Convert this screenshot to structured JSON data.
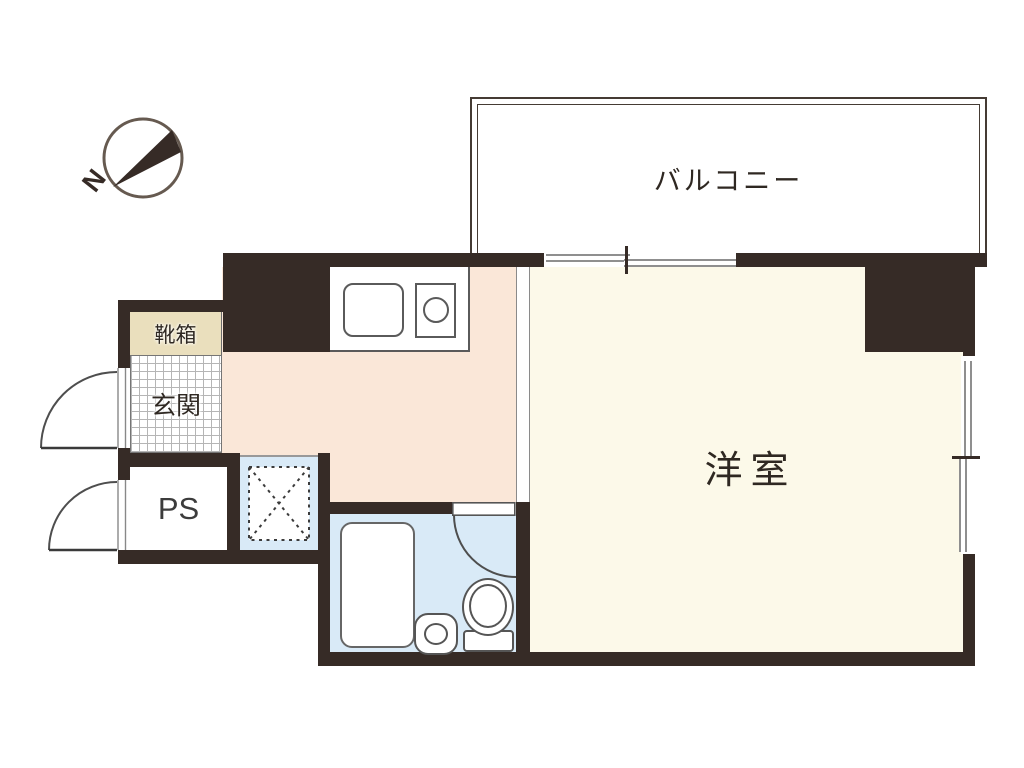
{
  "plan": {
    "compass": {
      "north_label": "N"
    },
    "rooms": {
      "balcony": {
        "label": "バルコニー"
      },
      "western_room": {
        "label": "洋室"
      },
      "entrance": {
        "label": "玄関"
      },
      "shoe_box": {
        "label": "靴箱"
      },
      "pipe_space": {
        "label": "PS"
      }
    },
    "colors": {
      "wall": "#362b26",
      "kitchen_hall_floor": "#fae7d8",
      "western_room_floor": "#fcf9e9",
      "bathroom_floor": "#d9eaf7",
      "shoe_box_fill": "#eadfbd",
      "entrance_grid": "#b5b5b5",
      "window_frame": "#8f8f8f"
    },
    "fixtures": {
      "kitchen_sink": "kitchen-sink",
      "stove": "single-burner-stove",
      "bathtub": "bathtub",
      "wash_basin": "wash-basin",
      "toilet": "toilet",
      "washer_space": "crossed-dashed-box",
      "entrance_door": "outward-swing-door",
      "pipe_space_door": "outward-swing-door",
      "bathroom_door": "inward-swing-door",
      "balcony_window": "sliding-window",
      "side_window": "sliding-window"
    }
  }
}
